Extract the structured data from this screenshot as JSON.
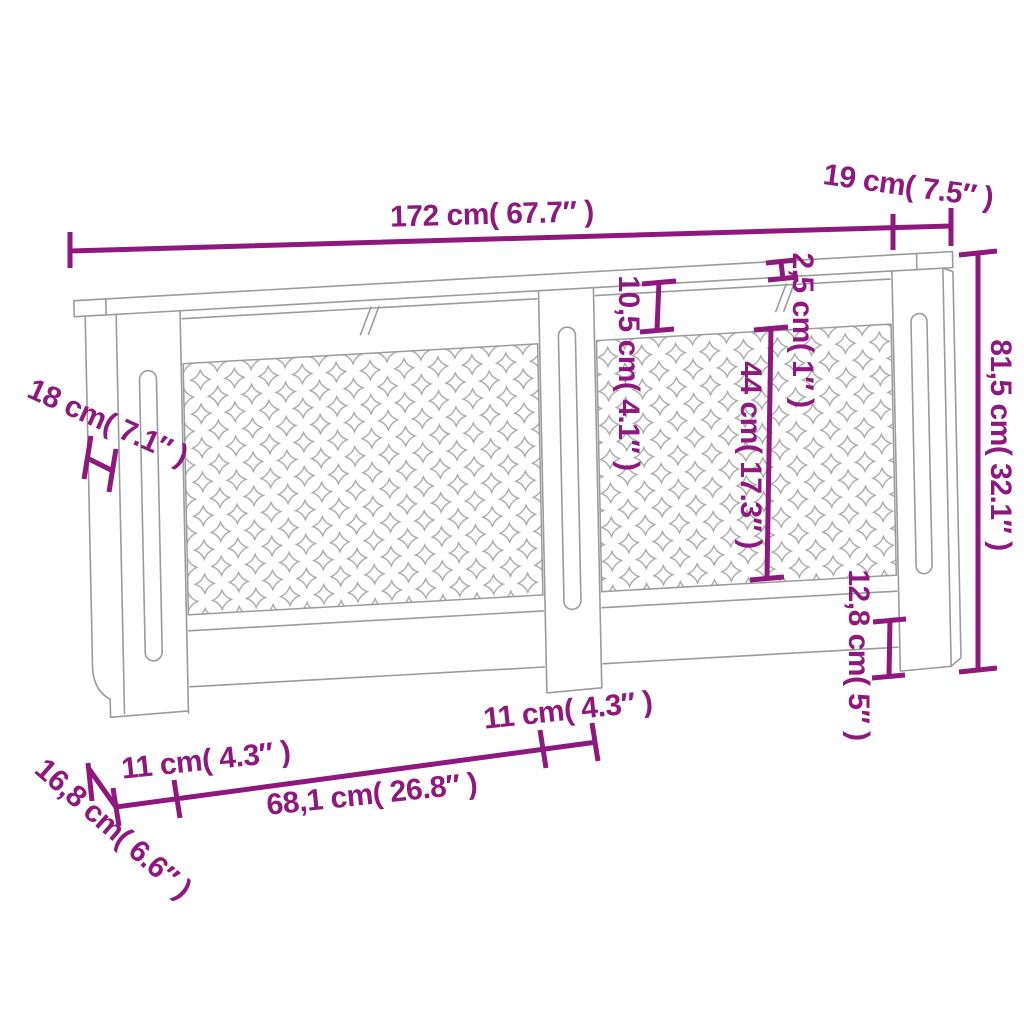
{
  "diagram": {
    "kind": "product-dimension-diagram",
    "subject": "MDF radiator cover cabinet line drawing with clover grille panels"
  },
  "labels": {
    "overall_width": "172 cm( 67.7″ )",
    "top_shelf_depth": "19 cm( 7.5″ )",
    "side_depth": "18 cm( 7.1″ )",
    "shelf_thickness": "2,5 cm( 1″ )",
    "top_rail_height": "10,5 cm( 4.1″ )",
    "grille_height": "44 cm( 17.3″ )",
    "overall_height": "81,5 cm( 32.1″ )",
    "bottom_rail_height": "12,8 cm( 5″ )",
    "left_post_width": "11 cm( 4.3″ )",
    "center_panel_width": "68,1 cm( 26.8″ )",
    "center_post_width": "11 cm( 4.3″ )",
    "base_side_depth": "16,8 cm( 6.6″ )"
  },
  "colors": {
    "dimension_accent": "#8e187d",
    "line_art": "#9b9b9b",
    "background": "#ffffff"
  }
}
